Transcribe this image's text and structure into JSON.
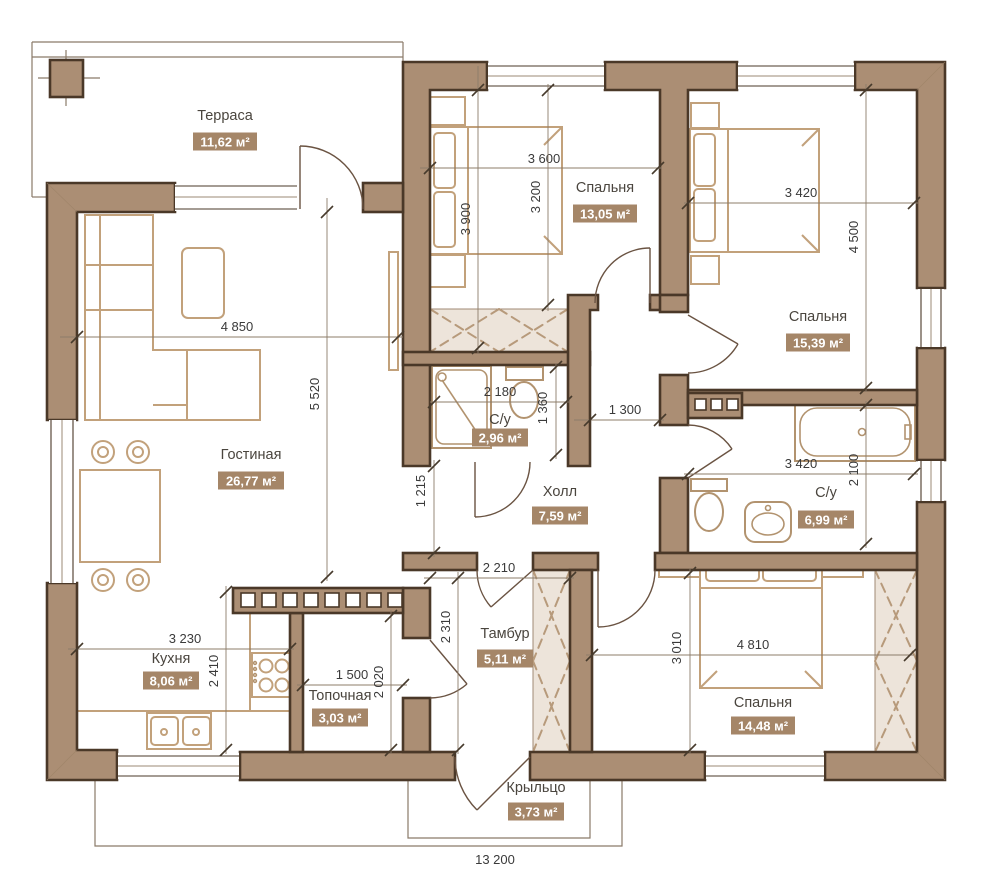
{
  "colors": {
    "wall_fill": "#ab8e74",
    "wall_outline": "#4a3828",
    "area_badge_bg": "#a58668",
    "area_badge_text": "#ffffff",
    "furniture_line": "#c2a17b",
    "closet_fill": "#ede4da",
    "dimension_text": "#3a3a3a"
  },
  "rooms": {
    "terrace": {
      "label": "Терраса",
      "area": "11,62 м²"
    },
    "bedroom1": {
      "label": "Спальня",
      "area": "13,05 м²"
    },
    "bedroom2": {
      "label": "Спальня",
      "area": "15,39 м²"
    },
    "living": {
      "label": "Гостиная",
      "area": "26,77 м²"
    },
    "bath_small": {
      "label": "С/у",
      "area": "2,96 м²"
    },
    "hall": {
      "label": "Холл",
      "area": "7,59 м²"
    },
    "bath_big": {
      "label": "С/у",
      "area": "6,99 м²"
    },
    "kitchen": {
      "label": "Кухня",
      "area": "8,06 м²"
    },
    "boiler": {
      "label": "Топочная",
      "area": "3,03 м²"
    },
    "vestibule": {
      "label": "Тамбур",
      "area": "5,11 м²"
    },
    "bedroom3": {
      "label": "Спальня",
      "area": "14,48 м²"
    },
    "porch": {
      "label": "Крыльцо",
      "area": "3,73 м²"
    }
  },
  "dims": {
    "bedroom1_w": "3 600",
    "bedroom1_h": "3 200",
    "bedroom1_h2": "3 900",
    "bedroom2_w": "3 420",
    "bedroom2_h": "4 500",
    "living_w": "4 850",
    "living_h": "5 520",
    "bath_small_w": "2 180",
    "bath_small_h": "1 360",
    "corridor_w": "1 300",
    "passage_h": "1 215",
    "bath_big_w": "3 420",
    "bath_big_h": "2 100",
    "vestibule_w": "2 210",
    "vestibule_h": "2 310",
    "kitchen_w": "3 230",
    "kitchen_h": "2 410",
    "boiler_w": "1 500",
    "boiler_h": "2 020",
    "bedroom3_w": "4 810",
    "bedroom3_h": "3 010",
    "total_w": "13 200"
  }
}
